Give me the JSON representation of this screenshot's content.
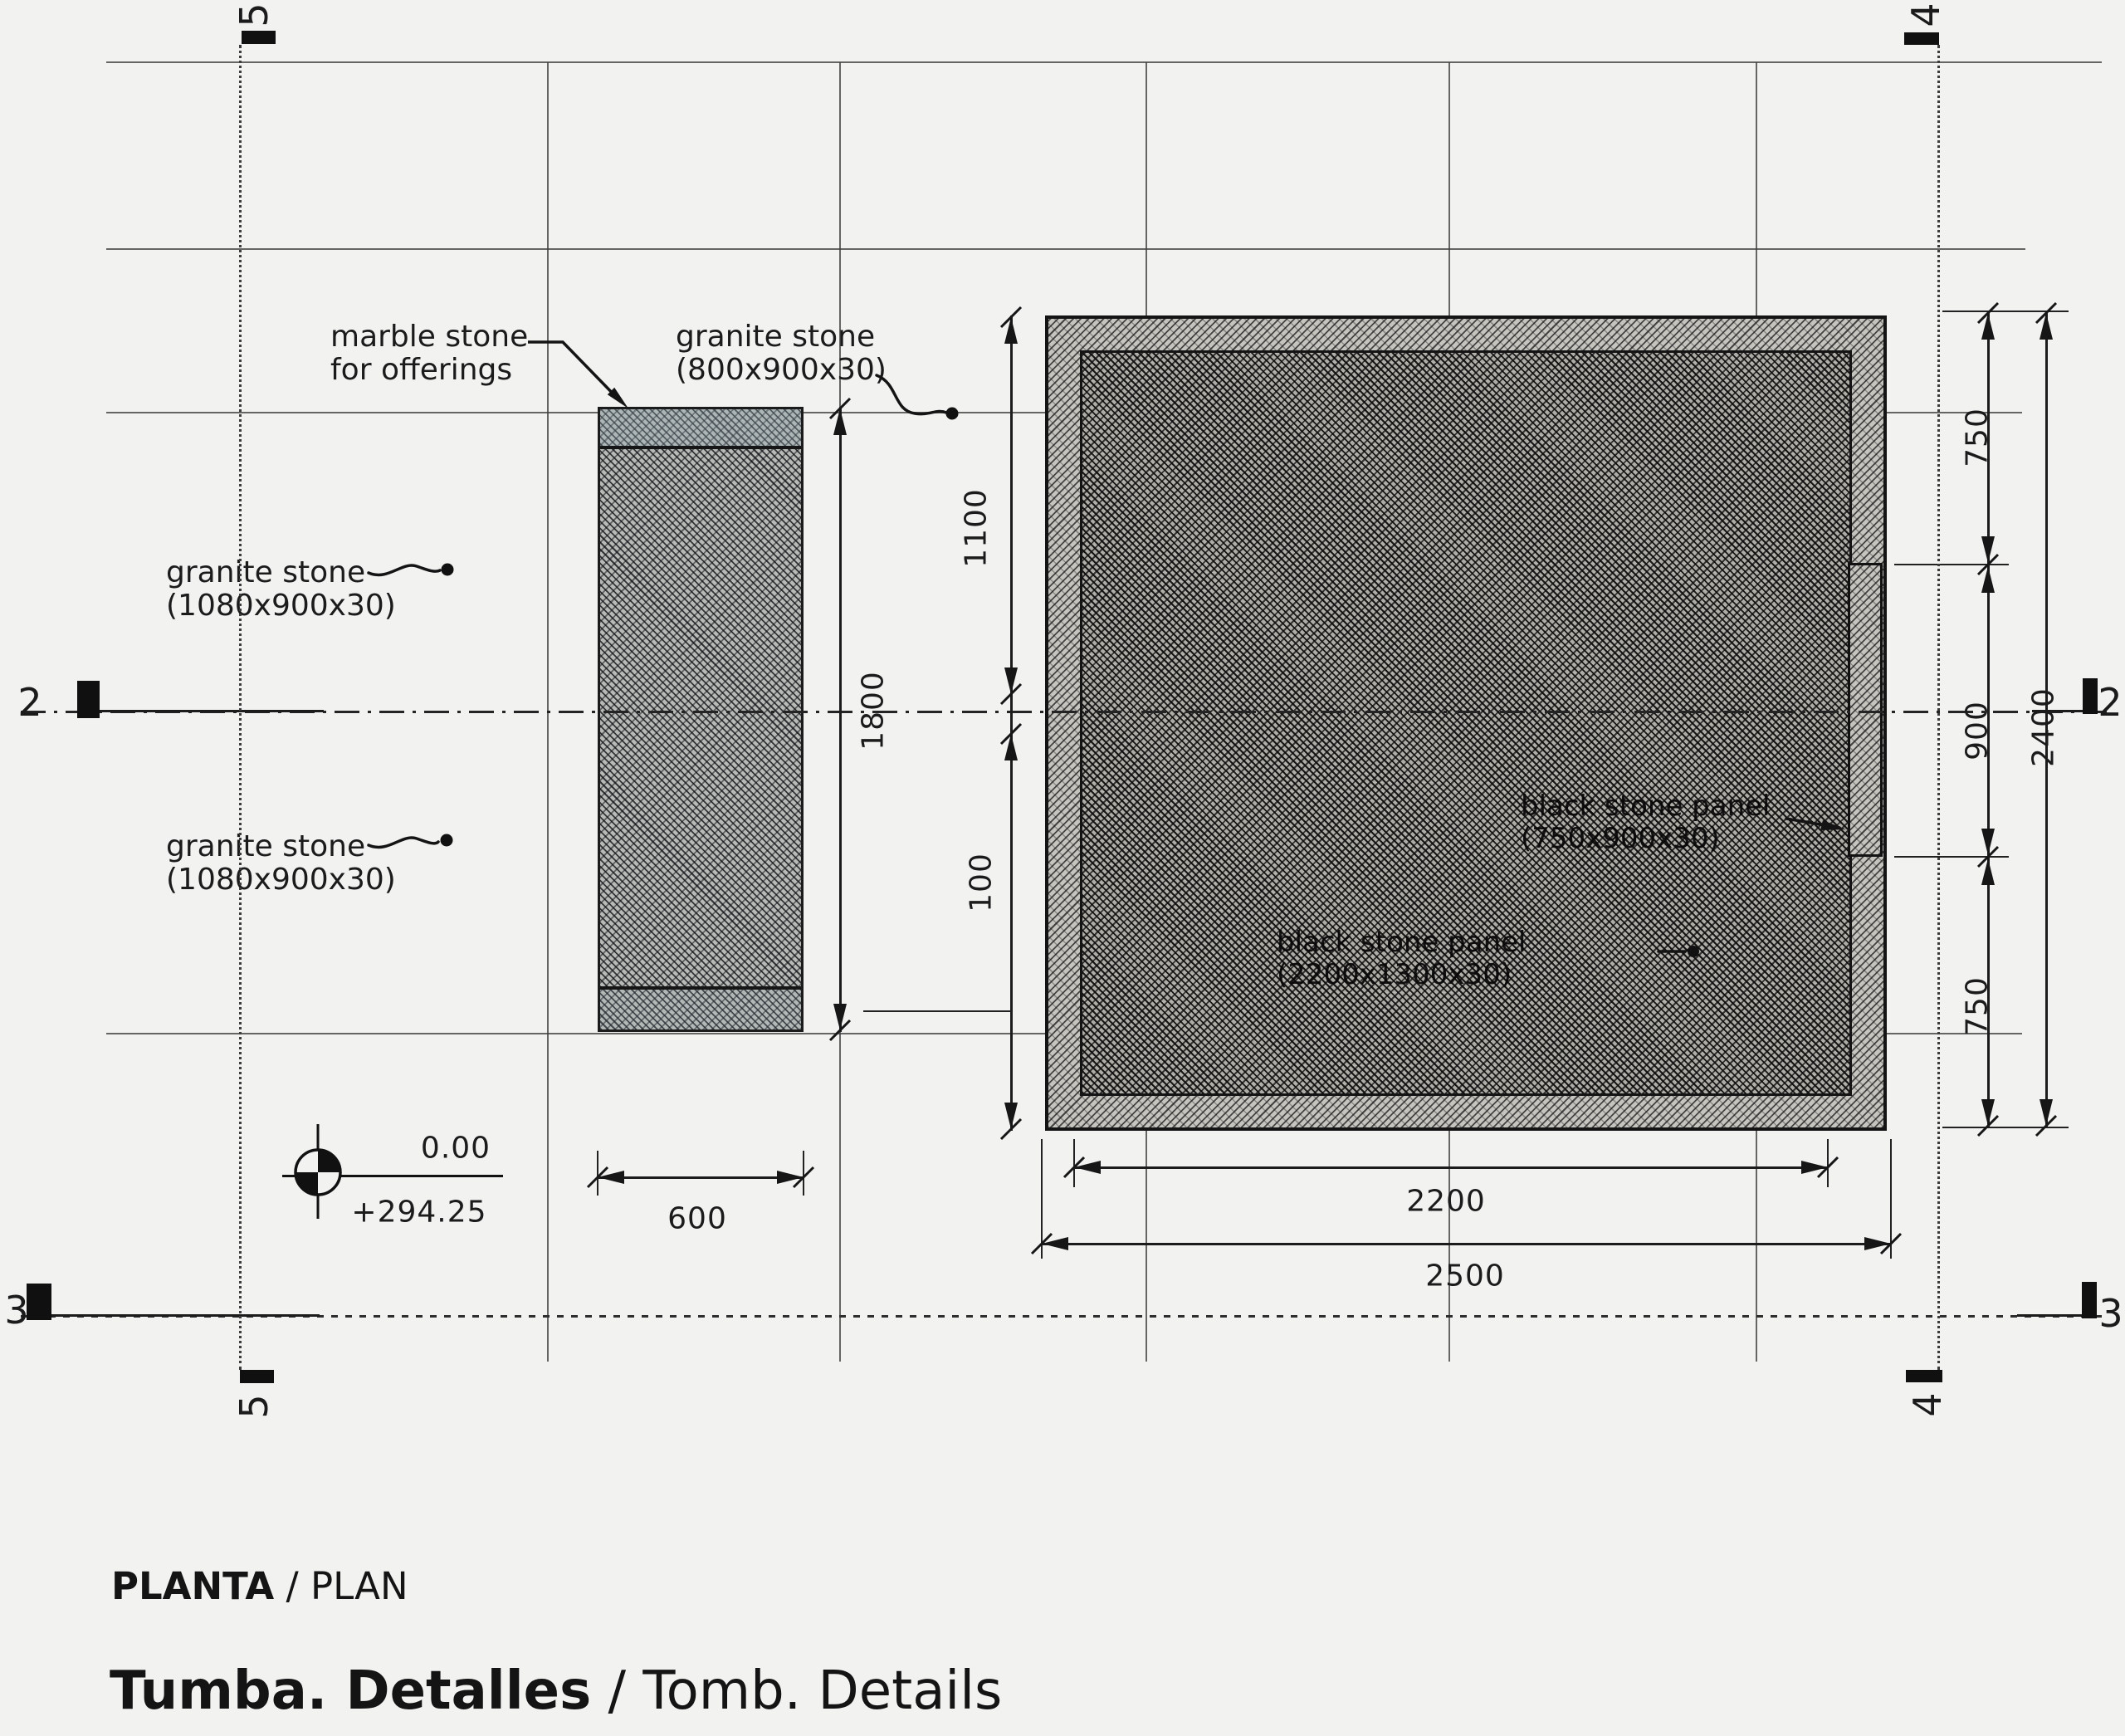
{
  "title_block": {
    "planta_bold": "PLANTA",
    "planta_rest": " / PLAN",
    "tumba_bold": "Tumba. Detalles",
    "tumba_rest": " / Tomb. Details"
  },
  "labels": {
    "marble_line1": "marble stone",
    "marble_line2": "for offerings",
    "granite800_line1": "granite stone",
    "granite800_line2": "(800x900x30)",
    "granite1080a_line1": "granite stone",
    "granite1080a_line2": "(1080x900x30)",
    "granite1080b_line1": "granite stone",
    "granite1080b_line2": "(1080x900x30)",
    "panel_right_line1": "black stone panel",
    "panel_right_line2": "(750x900x30)",
    "panel_main_line1": "black stone panel",
    "panel_main_line2": "(2200x1300x30)"
  },
  "dims": {
    "width_small": "600",
    "width_inner": "2200",
    "width_outer": "2500",
    "height_upper": "1100",
    "offset": "100",
    "height_small": "1800",
    "right_top": "750",
    "right_mid": "900",
    "right_bottom": "750",
    "right_total": "2400"
  },
  "level": {
    "elevation": "0.00",
    "datum": "+294.25"
  },
  "grid": {
    "axis5": "5",
    "axis4": "4",
    "axis2": "2",
    "axis3": "3"
  },
  "colors": {
    "paper": "#f2f3f1",
    "ink": "#1b1b1b",
    "marble_tint": "#9fb4bc"
  }
}
